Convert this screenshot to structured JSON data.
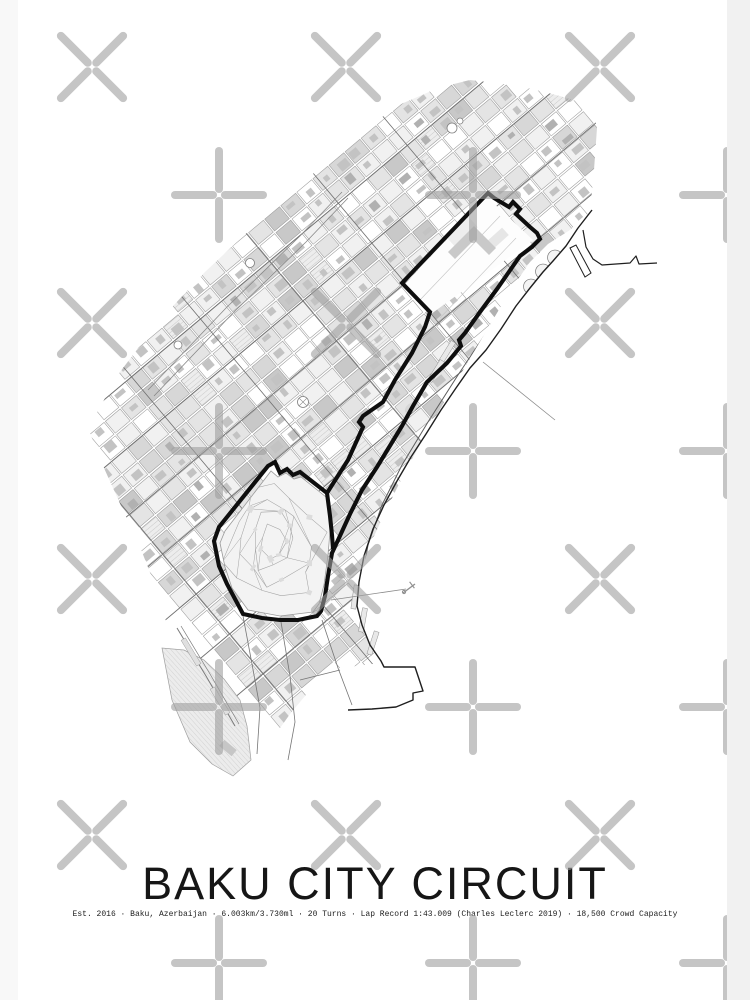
{
  "poster": {
    "title": "BAKU CITY CIRCUIT",
    "subtitle": "Est. 2016 · Baku, Azerbaijan · 6.003km/3.730ml · 20 Turns · Lap Record 1:43.009 (Charles Leclerc 2019) · 18,500 Crowd Capacity"
  },
  "map": {
    "name": "baku-street-map",
    "colors": {
      "circuit": "#0e0e0e",
      "coast": "#1f1f1f",
      "street": "#9a9a9a",
      "road": "#6f6f6f",
      "block": "#c3c3c3",
      "block_dark": "#b1b1b1",
      "old_town_fill": "#f3f3f3",
      "organic": "#a3a3a3",
      "thin_line": "#8a8a8a"
    },
    "grid": {
      "angle_deg": -40,
      "cell_u": 21,
      "cell_v": 17.5,
      "origin": [
        330,
        380
      ]
    },
    "city_outline": [
      [
        88,
        428
      ],
      [
        104,
        468
      ],
      [
        122,
        508
      ],
      [
        142,
        552
      ],
      [
        160,
        598
      ],
      [
        172,
        645
      ],
      [
        186,
        694
      ],
      [
        200,
        733
      ],
      [
        216,
        764
      ],
      [
        235,
        781
      ],
      [
        252,
        770
      ],
      [
        268,
        745
      ],
      [
        290,
        714
      ],
      [
        310,
        690
      ],
      [
        340,
        668
      ],
      [
        381,
        663
      ],
      [
        366,
        636
      ],
      [
        356,
        608
      ],
      [
        358,
        580
      ],
      [
        370,
        545
      ],
      [
        386,
        510
      ],
      [
        406,
        470
      ],
      [
        428,
        430
      ],
      [
        450,
        392
      ],
      [
        472,
        355
      ],
      [
        494,
        318
      ],
      [
        512,
        288
      ],
      [
        530,
        262
      ],
      [
        548,
        244
      ],
      [
        570,
        230
      ],
      [
        590,
        212
      ],
      [
        594,
        170
      ],
      [
        597,
        128
      ],
      [
        592,
        106
      ],
      [
        560,
        96
      ],
      [
        520,
        86
      ],
      [
        470,
        80
      ],
      [
        438,
        88
      ],
      [
        392,
        108
      ],
      [
        355,
        142
      ],
      [
        310,
        176
      ],
      [
        258,
        222
      ],
      [
        205,
        272
      ],
      [
        158,
        322
      ],
      [
        120,
        372
      ]
    ],
    "top_loop": [
      [
        403,
        286
      ],
      [
        487,
        197
      ],
      [
        533,
        240
      ],
      [
        431,
        314
      ]
    ],
    "old_town": [
      [
        326,
        497
      ],
      [
        301,
        477
      ],
      [
        294,
        479
      ],
      [
        286,
        473
      ],
      [
        278,
        477
      ],
      [
        271,
        471
      ],
      [
        225,
        531
      ],
      [
        220,
        543
      ],
      [
        225,
        567
      ],
      [
        232,
        588
      ],
      [
        248,
        610
      ],
      [
        280,
        616
      ],
      [
        313,
        612
      ],
      [
        319,
        604
      ],
      [
        324,
        585
      ],
      [
        328,
        555
      ],
      [
        331,
        520
      ],
      [
        330,
        503
      ]
    ],
    "peninsula": [
      [
        162,
        648
      ],
      [
        172,
        700
      ],
      [
        190,
        742
      ],
      [
        212,
        764
      ],
      [
        233,
        776
      ],
      [
        251,
        760
      ],
      [
        247,
        726
      ],
      [
        240,
        700
      ],
      [
        224,
        679
      ],
      [
        204,
        660
      ],
      [
        184,
        650
      ]
    ],
    "circuit": {
      "width": 4.1,
      "main": [
        [
          402,
          283
        ],
        [
          488,
          193
        ],
        [
          494,
          198
        ],
        [
          509,
          207
        ],
        [
          513,
          202
        ],
        [
          520,
          209
        ],
        [
          516,
          214
        ],
        [
          530,
          227
        ],
        [
          537,
          233
        ],
        [
          540,
          239
        ],
        [
          532,
          247
        ],
        [
          520,
          256
        ],
        [
          497,
          289
        ],
        [
          480,
          312
        ],
        [
          465,
          333
        ],
        [
          459,
          340
        ],
        [
          461,
          346
        ],
        [
          447,
          363
        ],
        [
          427,
          382
        ],
        [
          413,
          406
        ],
        [
          402,
          426
        ],
        [
          388,
          449
        ],
        [
          377,
          467
        ],
        [
          362,
          490
        ],
        [
          350,
          514
        ],
        [
          339,
          538
        ],
        [
          332,
          553
        ],
        [
          328,
          576
        ],
        [
          325,
          596
        ],
        [
          321,
          611
        ],
        [
          317,
          616
        ],
        [
          298,
          620
        ],
        [
          280,
          620
        ],
        [
          262,
          618
        ],
        [
          243,
          614
        ],
        [
          227,
          584
        ],
        [
          219,
          566
        ],
        [
          214,
          541
        ],
        [
          219,
          527
        ],
        [
          268,
          466
        ],
        [
          275,
          462
        ],
        [
          280,
          473
        ],
        [
          287,
          469
        ],
        [
          293,
          475
        ],
        [
          300,
          472
        ],
        [
          327,
          493
        ],
        [
          348,
          460
        ],
        [
          363,
          427
        ],
        [
          359,
          422
        ],
        [
          363,
          416
        ],
        [
          383,
          402
        ],
        [
          395,
          380
        ],
        [
          412,
          353
        ],
        [
          425,
          327
        ],
        [
          430,
          312
        ]
      ],
      "spur": [
        [
          327,
          493
        ],
        [
          330,
          516
        ],
        [
          332,
          535
        ],
        [
          333,
          549
        ]
      ]
    },
    "coastline": [
      [
        592,
        210
      ],
      [
        578,
        228
      ],
      [
        566,
        246
      ],
      [
        553,
        261
      ],
      [
        543,
        272
      ],
      [
        530,
        288
      ],
      [
        516,
        306
      ],
      [
        501,
        329
      ],
      [
        486,
        350
      ],
      [
        470,
        368
      ],
      [
        456,
        388
      ],
      [
        441,
        410
      ],
      [
        426,
        434
      ],
      [
        411,
        457
      ],
      [
        397,
        481
      ],
      [
        384,
        505
      ],
      [
        373,
        529
      ],
      [
        364,
        556
      ],
      [
        359,
        582
      ],
      [
        357,
        606
      ],
      [
        362,
        625
      ],
      [
        370,
        645
      ],
      [
        381,
        661
      ],
      [
        384,
        667
      ],
      [
        415,
        667
      ],
      [
        423,
        691
      ],
      [
        413,
        693
      ],
      [
        413,
        700
      ],
      [
        396,
        707
      ],
      [
        372,
        709
      ],
      [
        348,
        710
      ]
    ],
    "harbor_curve": [
      [
        583,
        230
      ],
      [
        586,
        247
      ],
      [
        593,
        259
      ],
      [
        602,
        265
      ],
      [
        630,
        263
      ],
      [
        636,
        256
      ],
      [
        639,
        264
      ],
      [
        657,
        263
      ]
    ],
    "jetty": [
      [
        570,
        248
      ],
      [
        576,
        245
      ],
      [
        591,
        273
      ],
      [
        585,
        277
      ]
    ],
    "ferry_line": [
      [
        483,
        362
      ],
      [
        555,
        420
      ]
    ],
    "pier_line": [
      [
        331,
        600
      ],
      [
        406,
        589
      ]
    ],
    "anchor": [
      411,
      587
    ],
    "boulevards": [
      [
        [
          540,
          252
        ],
        [
          516,
          288
        ],
        [
          488,
          330
        ],
        [
          458,
          375
        ],
        [
          428,
          422
        ],
        [
          402,
          465
        ],
        [
          382,
          505
        ],
        [
          368,
          545
        ],
        [
          361,
          585
        ],
        [
          364,
          618
        ],
        [
          376,
          648
        ]
      ],
      [
        [
          545,
          260
        ],
        [
          520,
          296
        ],
        [
          492,
          338
        ],
        [
          462,
          383
        ],
        [
          433,
          428
        ],
        [
          408,
          470
        ],
        [
          388,
          508
        ],
        [
          374,
          548
        ],
        [
          368,
          586
        ],
        [
          370,
          615
        ]
      ]
    ],
    "nw_edge_roads": [
      [
        [
          148,
          390
        ],
        [
          226,
          308
        ],
        [
          300,
          236
        ],
        [
          342,
          192
        ]
      ],
      [
        [
          154,
          396
        ],
        [
          232,
          314
        ],
        [
          306,
          242
        ],
        [
          348,
          198
        ]
      ]
    ],
    "south_roads": [
      [
        [
          322,
          620
        ],
        [
          338,
          668
        ],
        [
          352,
          705
        ]
      ],
      [
        [
          281,
          622
        ],
        [
          290,
          676
        ],
        [
          295,
          722
        ],
        [
          288,
          760
        ]
      ],
      [
        [
          243,
          616
        ],
        [
          252,
          664
        ],
        [
          260,
          708
        ],
        [
          257,
          754
        ]
      ],
      [
        [
          300,
          680
        ],
        [
          340,
          670
        ]
      ]
    ],
    "funicular": [
      [
        177,
        628
      ],
      [
        206,
        676
      ],
      [
        235,
        726
      ]
    ],
    "circles": [
      {
        "c": [
          303,
          402
        ],
        "r": 5.5,
        "cross": true
      },
      {
        "c": [
          250,
          263
        ],
        "r": 4.5,
        "cross": false
      },
      {
        "c": [
          178,
          345
        ],
        "r": 4,
        "cross": false
      },
      {
        "c": [
          452,
          128
        ],
        "r": 5,
        "cross": false
      },
      {
        "c": [
          460,
          121
        ],
        "r": 3,
        "cross": false
      }
    ],
    "gov_building": "M448,252 l26,-26 l22,22 l-7,7 l-15,-15 l-19,19 z"
  },
  "watermark": {
    "color": "#9e9e9e",
    "opacity": 0.6,
    "gap": 6,
    "arm": 38,
    "stroke_width": 8,
    "row_y_start": 67,
    "row_step": 128,
    "rows": 8,
    "x_cols": [
      92,
      346,
      600
    ],
    "plus_cols": [
      219,
      473,
      727
    ],
    "clip": [
      18,
      0,
      709,
      1000
    ]
  }
}
